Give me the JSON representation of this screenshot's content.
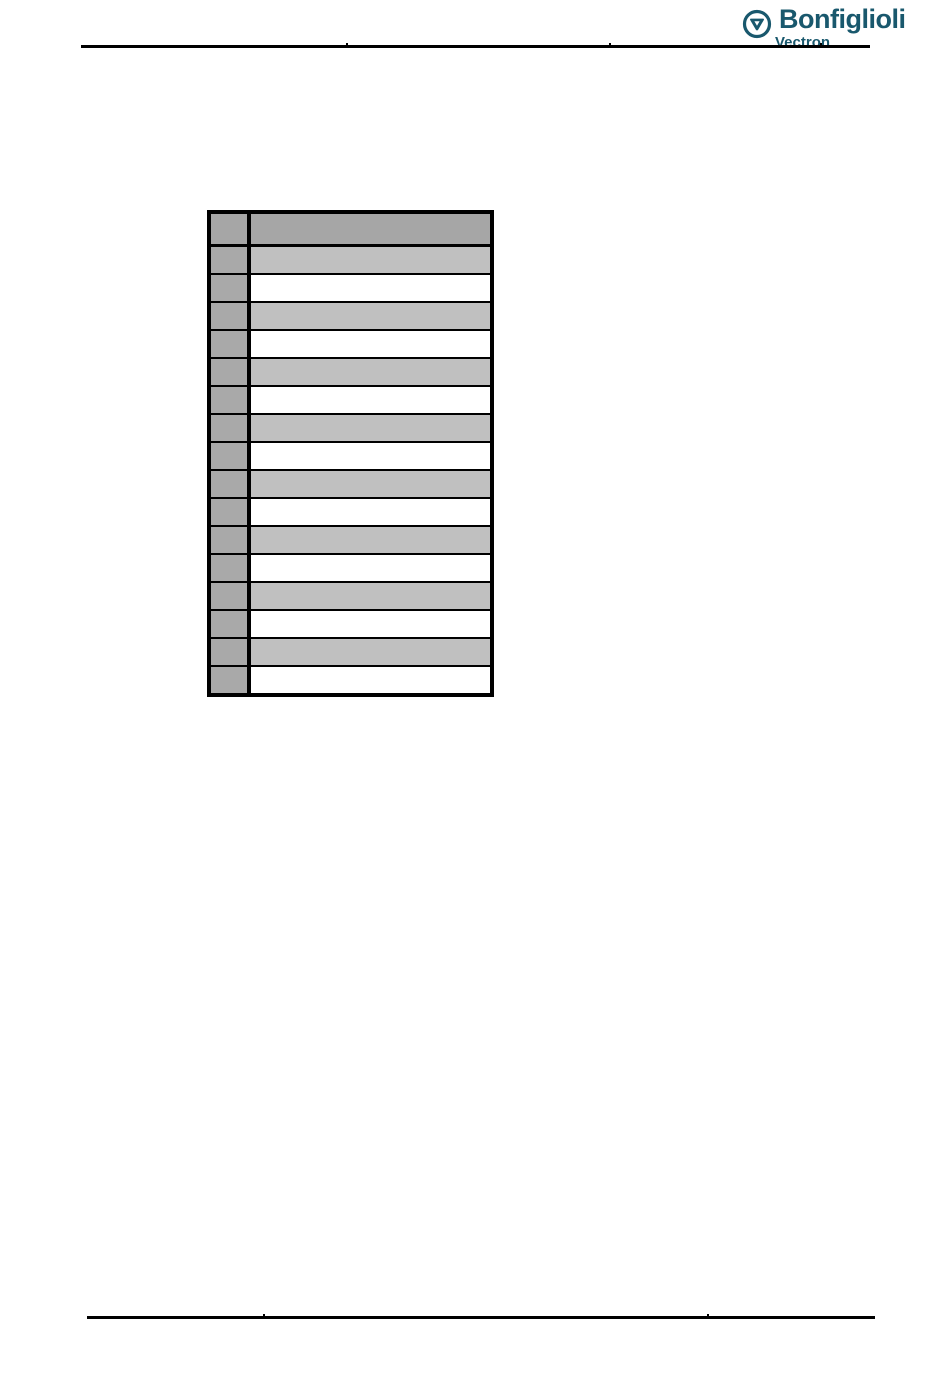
{
  "page": {
    "width": 950,
    "height": 1379,
    "background_color": "#ffffff"
  },
  "header": {
    "logo": {
      "brand": "Bonfiglioli",
      "sub_brand": "Vectron",
      "brand_color": "#19586d",
      "icon": "bonfiglioli-circle-triangle-icon"
    },
    "rule_color": "#000000"
  },
  "table": {
    "type": "table",
    "note": "empty two-column table, all cells blank",
    "border_color": "#000000",
    "header_fill_color": "#a6a6a6",
    "row_header_column_fill_color": "#a9a9a9",
    "striped_row_fill_color": "#c0c0c0",
    "plain_row_fill_color": "#ffffff",
    "header_cells": [
      "",
      ""
    ],
    "rows": [
      {
        "shade": "gray",
        "cells": [
          "",
          ""
        ]
      },
      {
        "shade": "white",
        "cells": [
          "",
          ""
        ]
      },
      {
        "shade": "gray",
        "cells": [
          "",
          ""
        ]
      },
      {
        "shade": "white",
        "cells": [
          "",
          ""
        ]
      },
      {
        "shade": "gray",
        "cells": [
          "",
          ""
        ]
      },
      {
        "shade": "white",
        "cells": [
          "",
          ""
        ]
      },
      {
        "shade": "gray",
        "cells": [
          "",
          ""
        ]
      },
      {
        "shade": "white",
        "cells": [
          "",
          ""
        ]
      },
      {
        "shade": "gray",
        "cells": [
          "",
          ""
        ]
      },
      {
        "shade": "white",
        "cells": [
          "",
          ""
        ]
      },
      {
        "shade": "gray",
        "cells": [
          "",
          ""
        ]
      },
      {
        "shade": "white",
        "cells": [
          "",
          ""
        ]
      },
      {
        "shade": "gray",
        "cells": [
          "",
          ""
        ]
      },
      {
        "shade": "white",
        "cells": [
          "",
          ""
        ]
      },
      {
        "shade": "gray",
        "cells": [
          "",
          ""
        ]
      },
      {
        "shade": "white",
        "cells": [
          "",
          ""
        ]
      }
    ]
  },
  "footer": {
    "rule_color": "#000000"
  }
}
